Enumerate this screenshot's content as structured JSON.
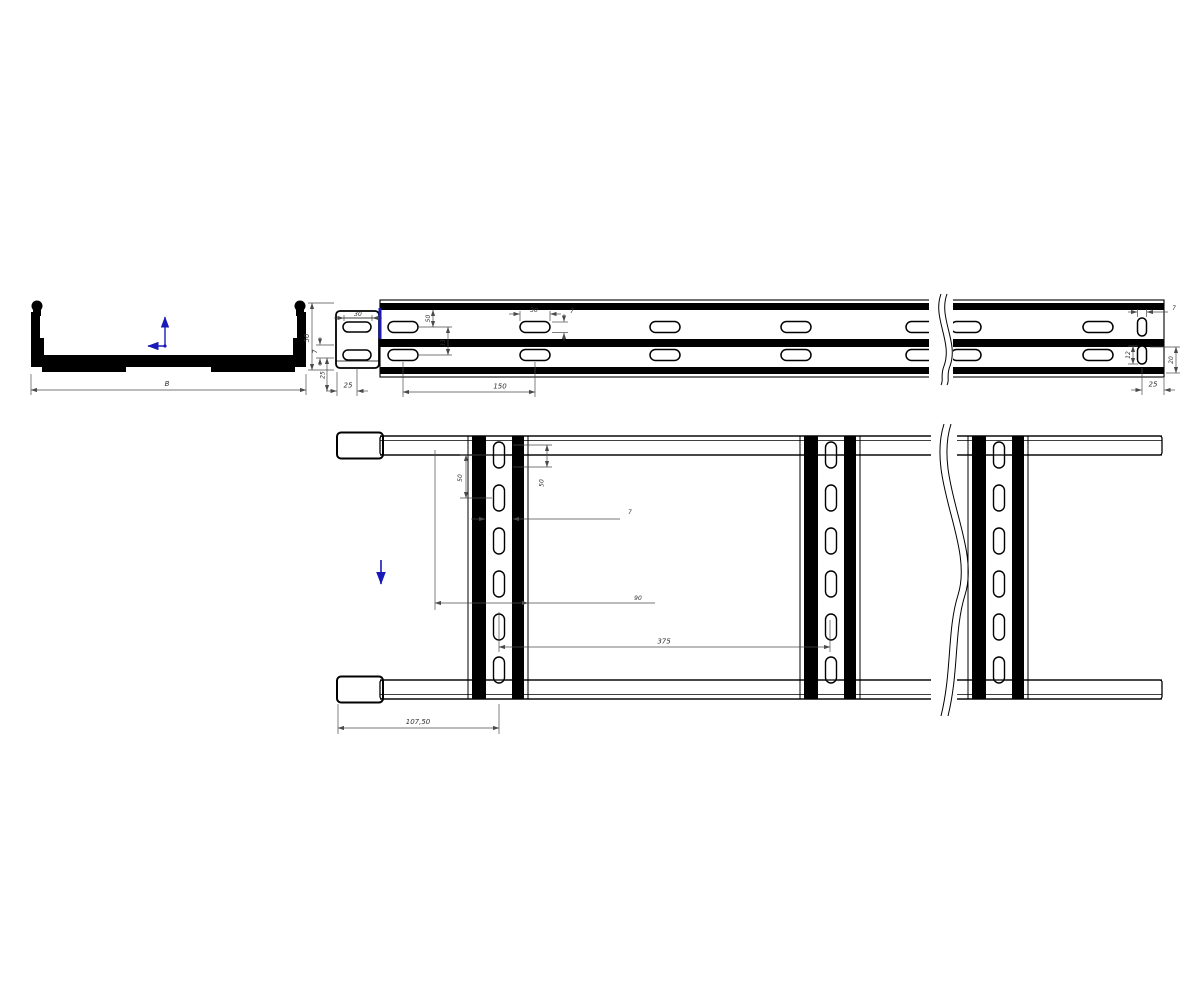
{
  "title": "cable-ladder-technical-drawing",
  "colors": {
    "background": "#ffffff",
    "ink": "#000000",
    "dimension": "#333333",
    "accent": "#1a1ab8"
  },
  "section_view": {
    "width_label": "B"
  },
  "dims": {
    "section_width": "B",
    "side_height": "50",
    "side_flange": "7",
    "side_base": "25",
    "side_left_margin": "25",
    "side_slot_len_a": "30",
    "side_slot_pitch": "150",
    "side_row_offset": "50",
    "side_row_gap": "33",
    "side_slot_len_b": "30",
    "side_slot_h": "7",
    "side_end_slot_w": "7",
    "side_end_slot_gap": "12",
    "side_end_slot_h": "20",
    "side_end_margin": "25",
    "plan_slot_pitch": "50",
    "plan_edge_offset": "50",
    "plan_slot_width": "7",
    "plan_rung_width": "90",
    "plan_rung_spacing": "375",
    "plan_first_rung": "107,50"
  },
  "icons": {
    "ucs": "ucs-axis-icon",
    "flow": "flow-arrow-icon"
  }
}
